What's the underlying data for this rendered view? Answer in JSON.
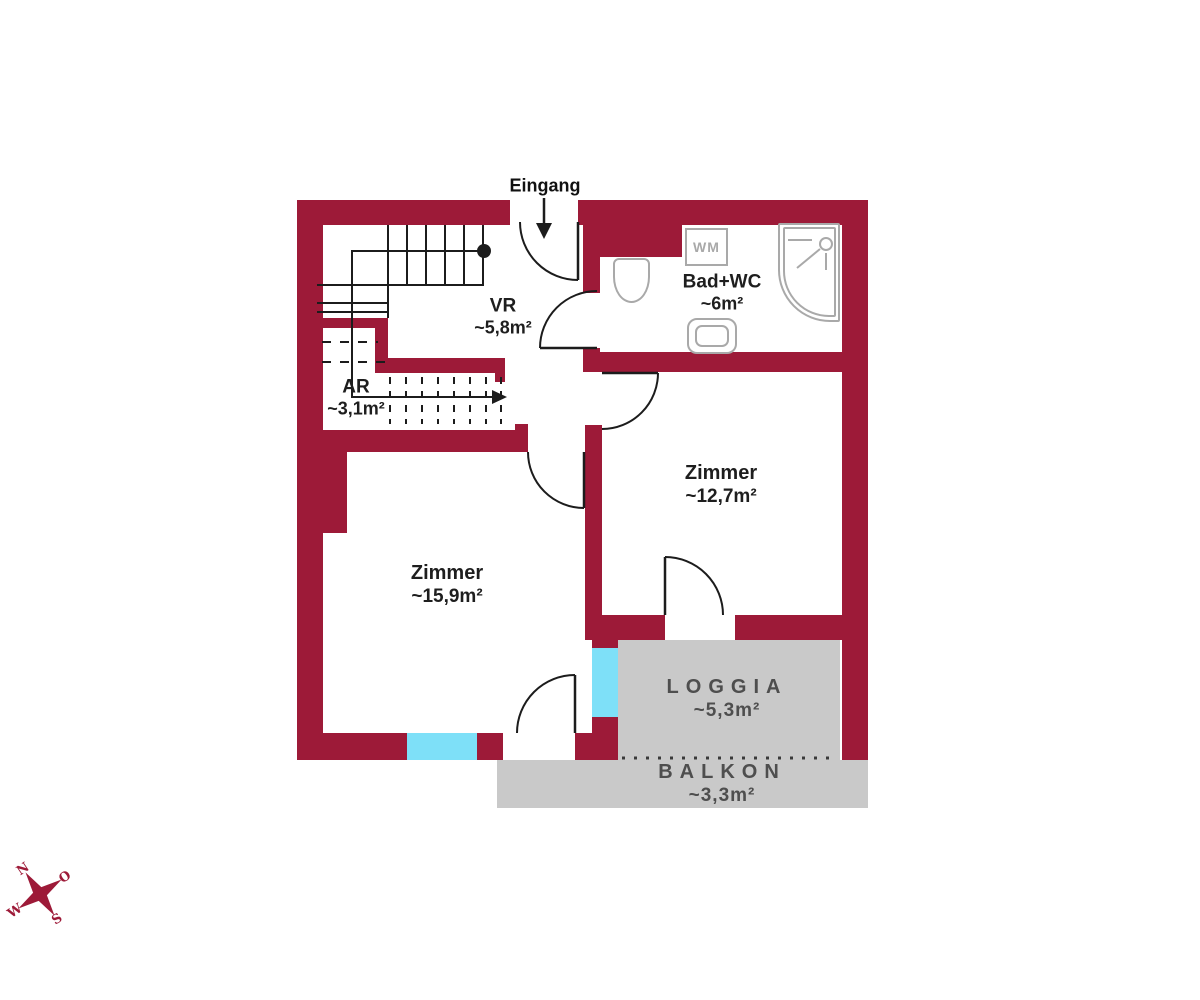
{
  "plan": {
    "entrance_label": "Eingang",
    "rooms": {
      "vr": {
        "name": "VR",
        "area": "~5,8m²"
      },
      "ar": {
        "name": "AR",
        "area": "~3,1m²"
      },
      "bad": {
        "name": "Bad+WC",
        "area": "~6m²"
      },
      "zimmer_127": {
        "name": "Zimmer",
        "area": "~12,7m²"
      },
      "zimmer_159": {
        "name": "Zimmer",
        "area": "~15,9m²"
      },
      "loggia": {
        "name": "LOGGIA",
        "area": "~5,3m²"
      },
      "balkon": {
        "name": "BALKON",
        "area": "~3,3m²"
      }
    },
    "fixtures": {
      "washing_machine": "WM"
    },
    "compass": {
      "north": "N",
      "east": "O",
      "south": "S",
      "west": "W"
    },
    "colors": {
      "wall": "#9d1a38",
      "window": "#7ee0f8",
      "outdoor": "#c9c9c9",
      "line": "#1c1c1c",
      "fixture": "#a9a9a9"
    }
  }
}
